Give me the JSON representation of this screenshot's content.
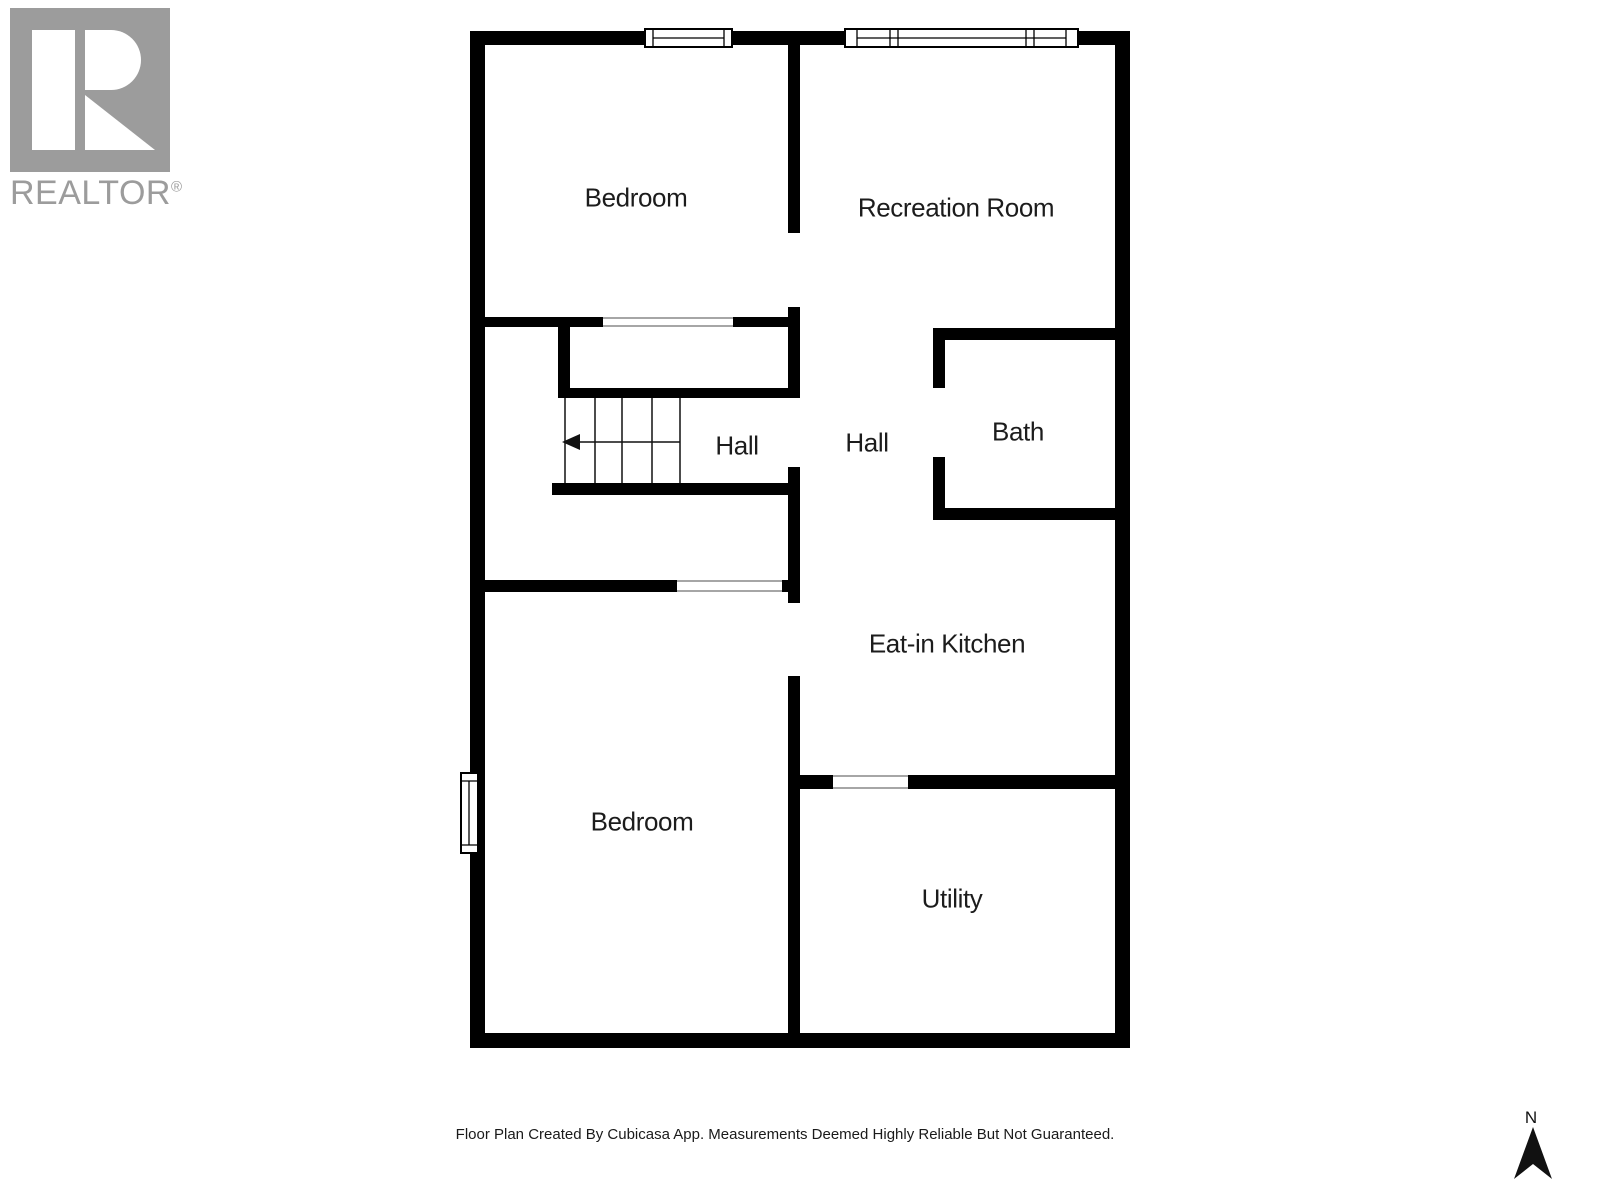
{
  "logo": {
    "brand": "REALTOR",
    "registered_mark": "®"
  },
  "plan": {
    "rooms": [
      {
        "label": "Bedroom"
      },
      {
        "label": "Recreation Room"
      },
      {
        "label": "Hall"
      },
      {
        "label": "Hall"
      },
      {
        "label": "Bath"
      },
      {
        "label": "Eat-in Kitchen"
      },
      {
        "label": "Bedroom"
      },
      {
        "label": "Utility"
      }
    ]
  },
  "compass": {
    "north_label": "N"
  },
  "footer": {
    "disclaimer": "Floor Plan Created By Cubicasa App. Measurements Deemed Highly Reliable But Not Guaranteed."
  },
  "colors": {
    "wall": "#000000",
    "logo_gray": "#9c9c9c",
    "text": "#1c1c1c"
  }
}
